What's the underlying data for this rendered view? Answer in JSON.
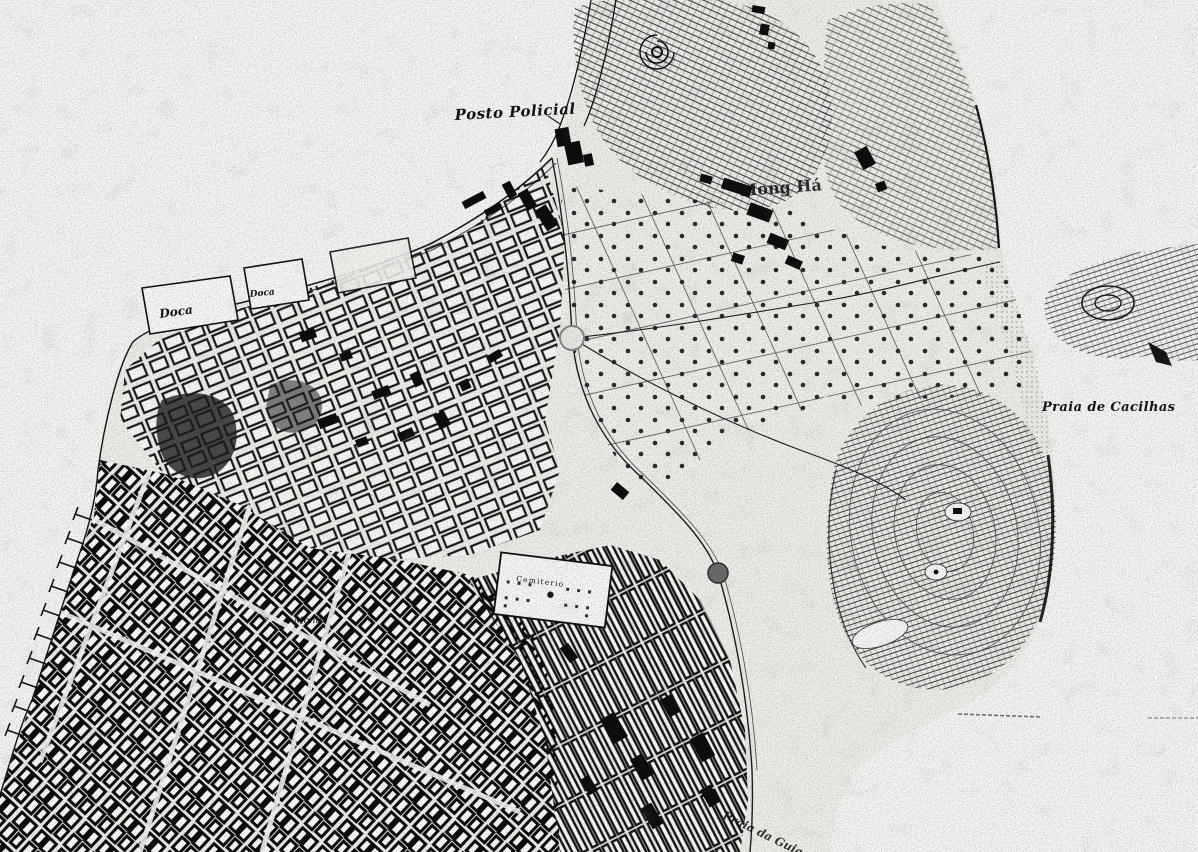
{
  "map": {
    "title": "Scanned historical city map (Macau peninsula)",
    "style": "black-and-white engraved scan",
    "palette": {
      "paper": "#f9f9f7",
      "land": "#f3f2ee",
      "ink": "#141414",
      "hill_hatch": "#2f2f2f",
      "road_gray": "#555555"
    },
    "labels": [
      {
        "id": "posto-policial",
        "text": "Posto Policial"
      },
      {
        "id": "doca-large",
        "text": "Doca"
      },
      {
        "id": "doca-small",
        "text": "Doca"
      },
      {
        "id": "mong-ha",
        "text": "Mong Há"
      },
      {
        "id": "praia-de-cacilhas",
        "text": "Praia de Cacilhas"
      },
      {
        "id": "cemiterio",
        "text": "Cemiterio"
      },
      {
        "id": "monte",
        "text": "Monte"
      },
      {
        "id": "praia-da-guia",
        "text": "Praia da Guia"
      }
    ],
    "features": [
      "west-coastline-with-piers",
      "inner-harbour-docks",
      "old-city-dense-street-grid",
      "central-plantation-fields-with-tree-dots",
      "mong-ha-hill-with-spiral-fort",
      "guia-hill-with-contour-hatching",
      "cacilhas-bay-and-northeast-hill",
      "walled-cemetery",
      "new-district-parallel-blocks",
      "roundabout-junctions"
    ]
  }
}
